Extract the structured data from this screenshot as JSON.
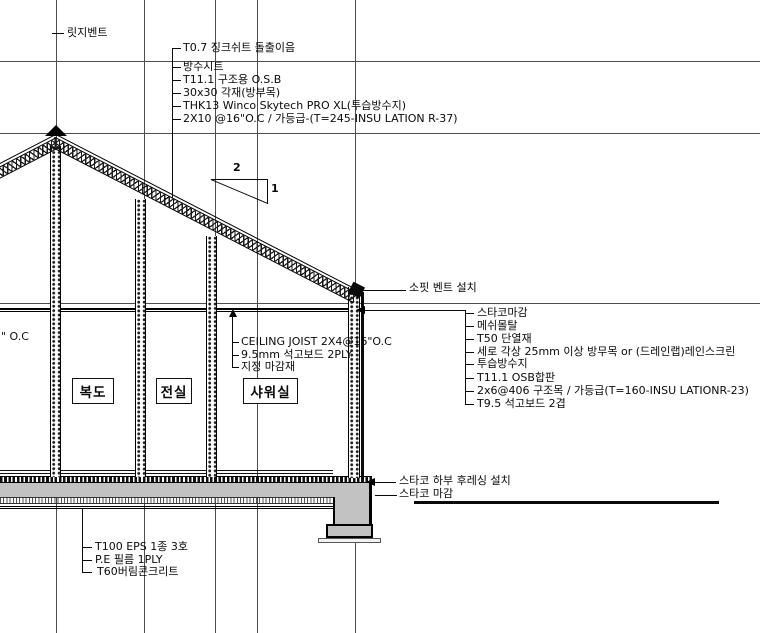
{
  "drawing": {
    "ridge_vent": "릿지벤트",
    "roof_assembly": [
      "T0.7 징크쉬트 돌출이음",
      "방수시트",
      "T11.1 구조용 O.S.B",
      "30x30 각재(방부목)",
      "THK13 Winco Skytech PRO XL(투습방수지)",
      "2X10 @16\"O.C / 가등급-(T=245-INSU LATION R-37)"
    ],
    "roof_slope": {
      "run": "2",
      "rise": "1"
    },
    "soffit_vent": "소핏 벤트 설치",
    "wall_assembly": [
      "스타코마감",
      "메쉬몰탈",
      "T50 단열재",
      "세로 각상 25mm 이상 방무목 or  (드레인랩)레인스크린",
      "투습방수지",
      "T11.1 OSB합판",
      "2x6@406 구조목 / 가등급(T=160-INSU LATIONR-23)",
      "T9.5 석고보드 2겹"
    ],
    "ceiling_assembly": [
      "CEILING JOIST 2X4@16\"O.C",
      "9.5mm 석고보드 2PLY",
      "지정 마감재"
    ],
    "rooms": [
      "복도",
      "전실",
      "샤워실"
    ],
    "floor_assembly": [
      "T100 EPS 1종 3호",
      "P.E 필름 1PLY",
      "T60버림콘크리트"
    ],
    "stucco_flashing": "스타코 하부 후레싱 설치",
    "stucco_finish": "스타코 마감",
    "left_edge_partial": "\" O.C"
  },
  "colors": {
    "line": "#111111",
    "concrete": "#c2c2c2",
    "background": "#ffffff"
  }
}
